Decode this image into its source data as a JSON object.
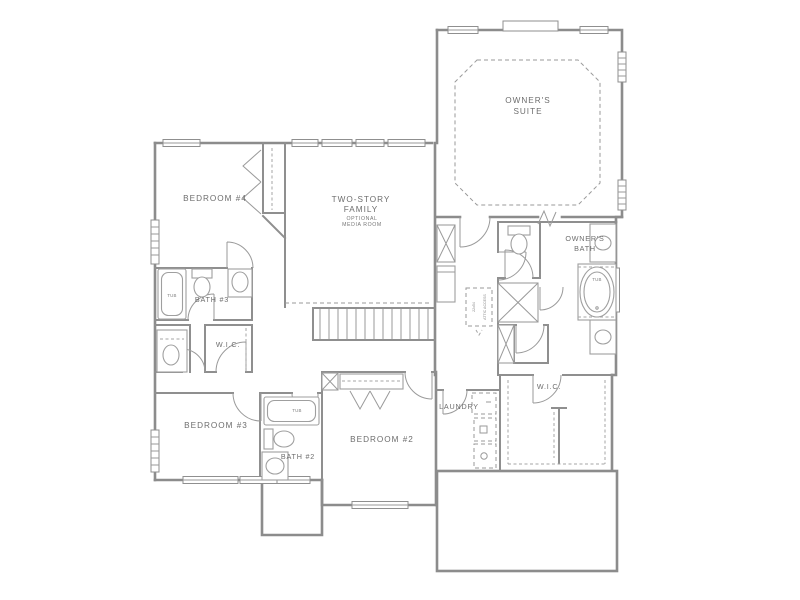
{
  "plan": {
    "labels": {
      "owners_suite_line1": "OWNER'S",
      "owners_suite_line2": "SUITE",
      "bedroom4": "BEDROOM #4",
      "family_line1": "TWO-STORY",
      "family_line2": "FAMILY",
      "media_line1": "OPTIONAL",
      "media_line2": "MEDIA ROOM",
      "bath3": "BATH #3",
      "wic_hall": "W.I.C.",
      "bedroom3": "BEDROOM #3",
      "bath2": "BATH #2",
      "bedroom2": "BEDROOM #2",
      "laundry": "LAUNDRY",
      "wic_owner": "W.I.C.",
      "owners_bath_line1": "OWNER'S",
      "owners_bath_line2": "BATH",
      "tub": "TUB",
      "attic_line1": "22x54",
      "attic_line2": "ATTIC ACCESS"
    },
    "colors": {
      "background": "#ffffff",
      "walls": "#8c8c8c",
      "fixtures": "#9f9f9f",
      "text": "#6d6d6d"
    }
  }
}
